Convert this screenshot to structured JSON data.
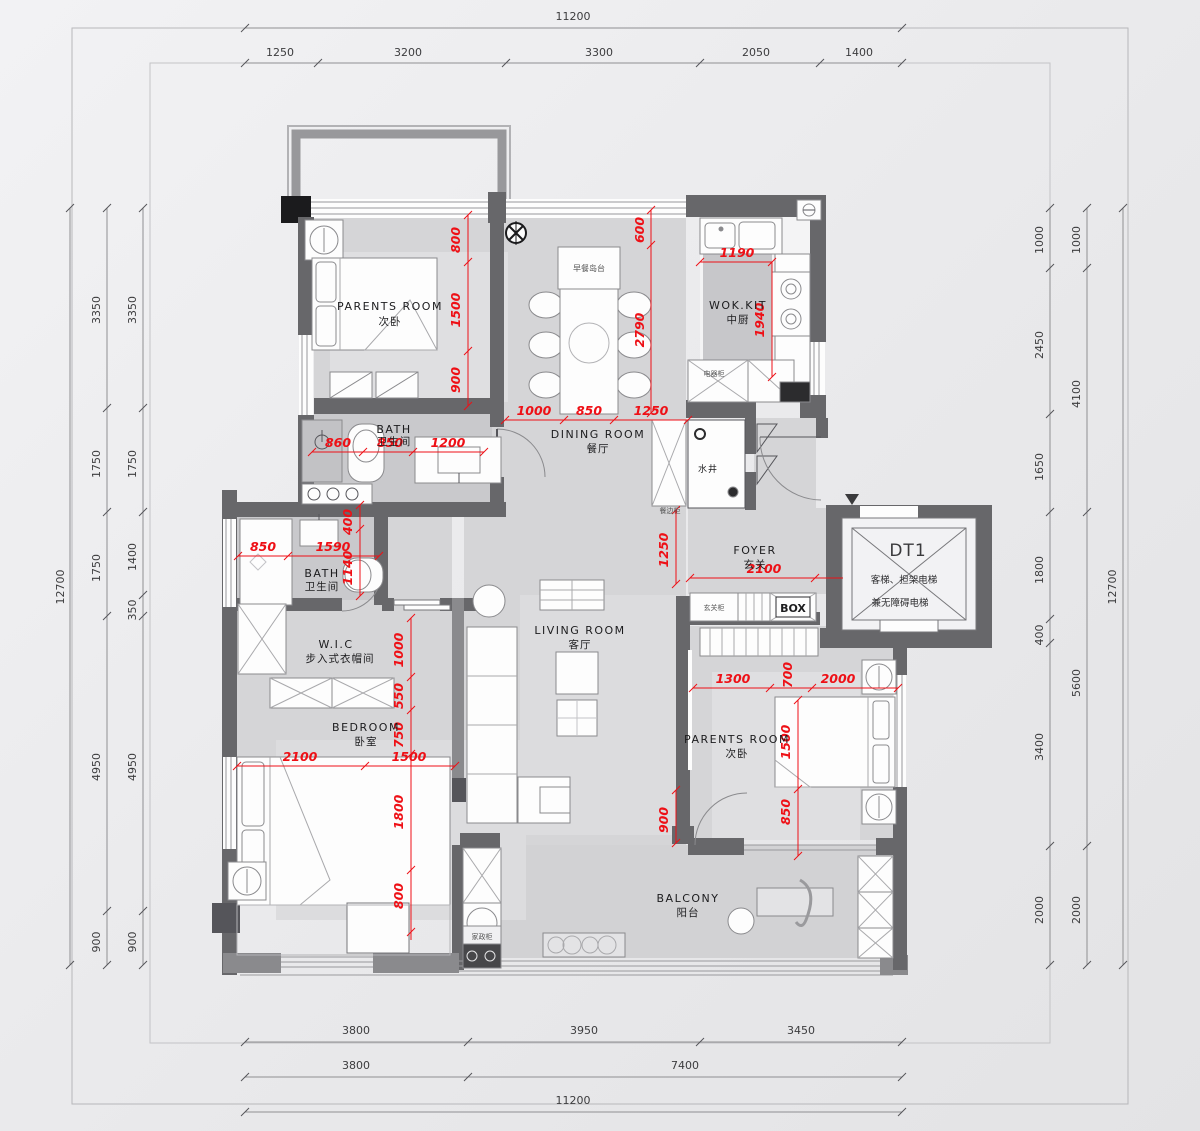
{
  "drawing": {
    "type": "residential floor plan",
    "units": "mm"
  },
  "dims": {
    "top_total": "11200",
    "top_segs": [
      "1250",
      "3200",
      "3300",
      "2050",
      "1400"
    ],
    "left_total": "12700",
    "left_mid": [
      "3350",
      "1750",
      "1750",
      "4950",
      "900"
    ],
    "left_inner": [
      "3350",
      "1750",
      "1400",
      "350",
      "4950",
      "900"
    ],
    "right_inner": [
      "1000",
      "2450",
      "1650",
      "1800",
      "400",
      "3400",
      "2000"
    ],
    "right_mid": [
      "1000",
      "4100",
      "5600",
      "2000"
    ],
    "right_total": "12700",
    "bottom_row1": [
      "3800",
      "3950",
      "3450"
    ],
    "bottom_row2": [
      "3800",
      "7400"
    ],
    "bottom_total": "11200"
  },
  "red_dims": {
    "a1": "800",
    "a2": "1500",
    "a3": "900",
    "b1": "600",
    "b2": "2790",
    "c1": "1190",
    "d1": "1940",
    "e1": "1000",
    "e2": "850",
    "e3": "1250",
    "f1": "860",
    "f2": "850",
    "f3": "1200",
    "g1": "400",
    "g2": "1140",
    "h1": "850",
    "h2": "1590",
    "i1": "1250",
    "j1": "2100",
    "k1": "1000",
    "k2": "550",
    "k3": "750",
    "k4": "1800",
    "k5": "800",
    "l1": "2100",
    "l2": "1500",
    "m1": "900",
    "n1": "1300",
    "n2": "700",
    "n3": "2000",
    "o1": "1500",
    "o2": "850"
  },
  "rooms": {
    "parents_left": {
      "en": "PARENTS ROOM",
      "cn": "次卧"
    },
    "dining": {
      "en": "DINING ROOM",
      "cn": "餐厅"
    },
    "wok": {
      "en": "WOK.KIT",
      "cn": "中厨"
    },
    "bath1": {
      "en": "BATH",
      "cn": "卫生间"
    },
    "bath2": {
      "en": "BATH",
      "cn": "卫生间"
    },
    "foyer": {
      "en": "FOYER",
      "cn": "玄关"
    },
    "wic": {
      "en": "W.I.C",
      "cn": "步入式衣帽间"
    },
    "bedroom": {
      "en": "BEDROOM",
      "cn": "卧室"
    },
    "living": {
      "en": "LIVING ROOM",
      "cn": "客厅"
    },
    "parents_right": {
      "en": "PARENTS ROOM",
      "cn": "次卧"
    },
    "balcony": {
      "en": "BALCONY",
      "cn": "阳台"
    },
    "shaft": {
      "cn": "水井"
    },
    "elevator": {
      "code": "DT1",
      "line1": "客梯、担架电梯",
      "line2": "兼无障碍电梯"
    }
  },
  "cabinets": {
    "island": "早餐岛台",
    "appliance": "电器柜",
    "sideboard": "餐边柜",
    "entry": "玄关柜",
    "box": "BOX",
    "laundry": "家政柜"
  },
  "colors": {
    "red_annotation": "#ee1016",
    "wall": "#67676a",
    "floor": "#d5d5d7",
    "background": "#ececee"
  }
}
